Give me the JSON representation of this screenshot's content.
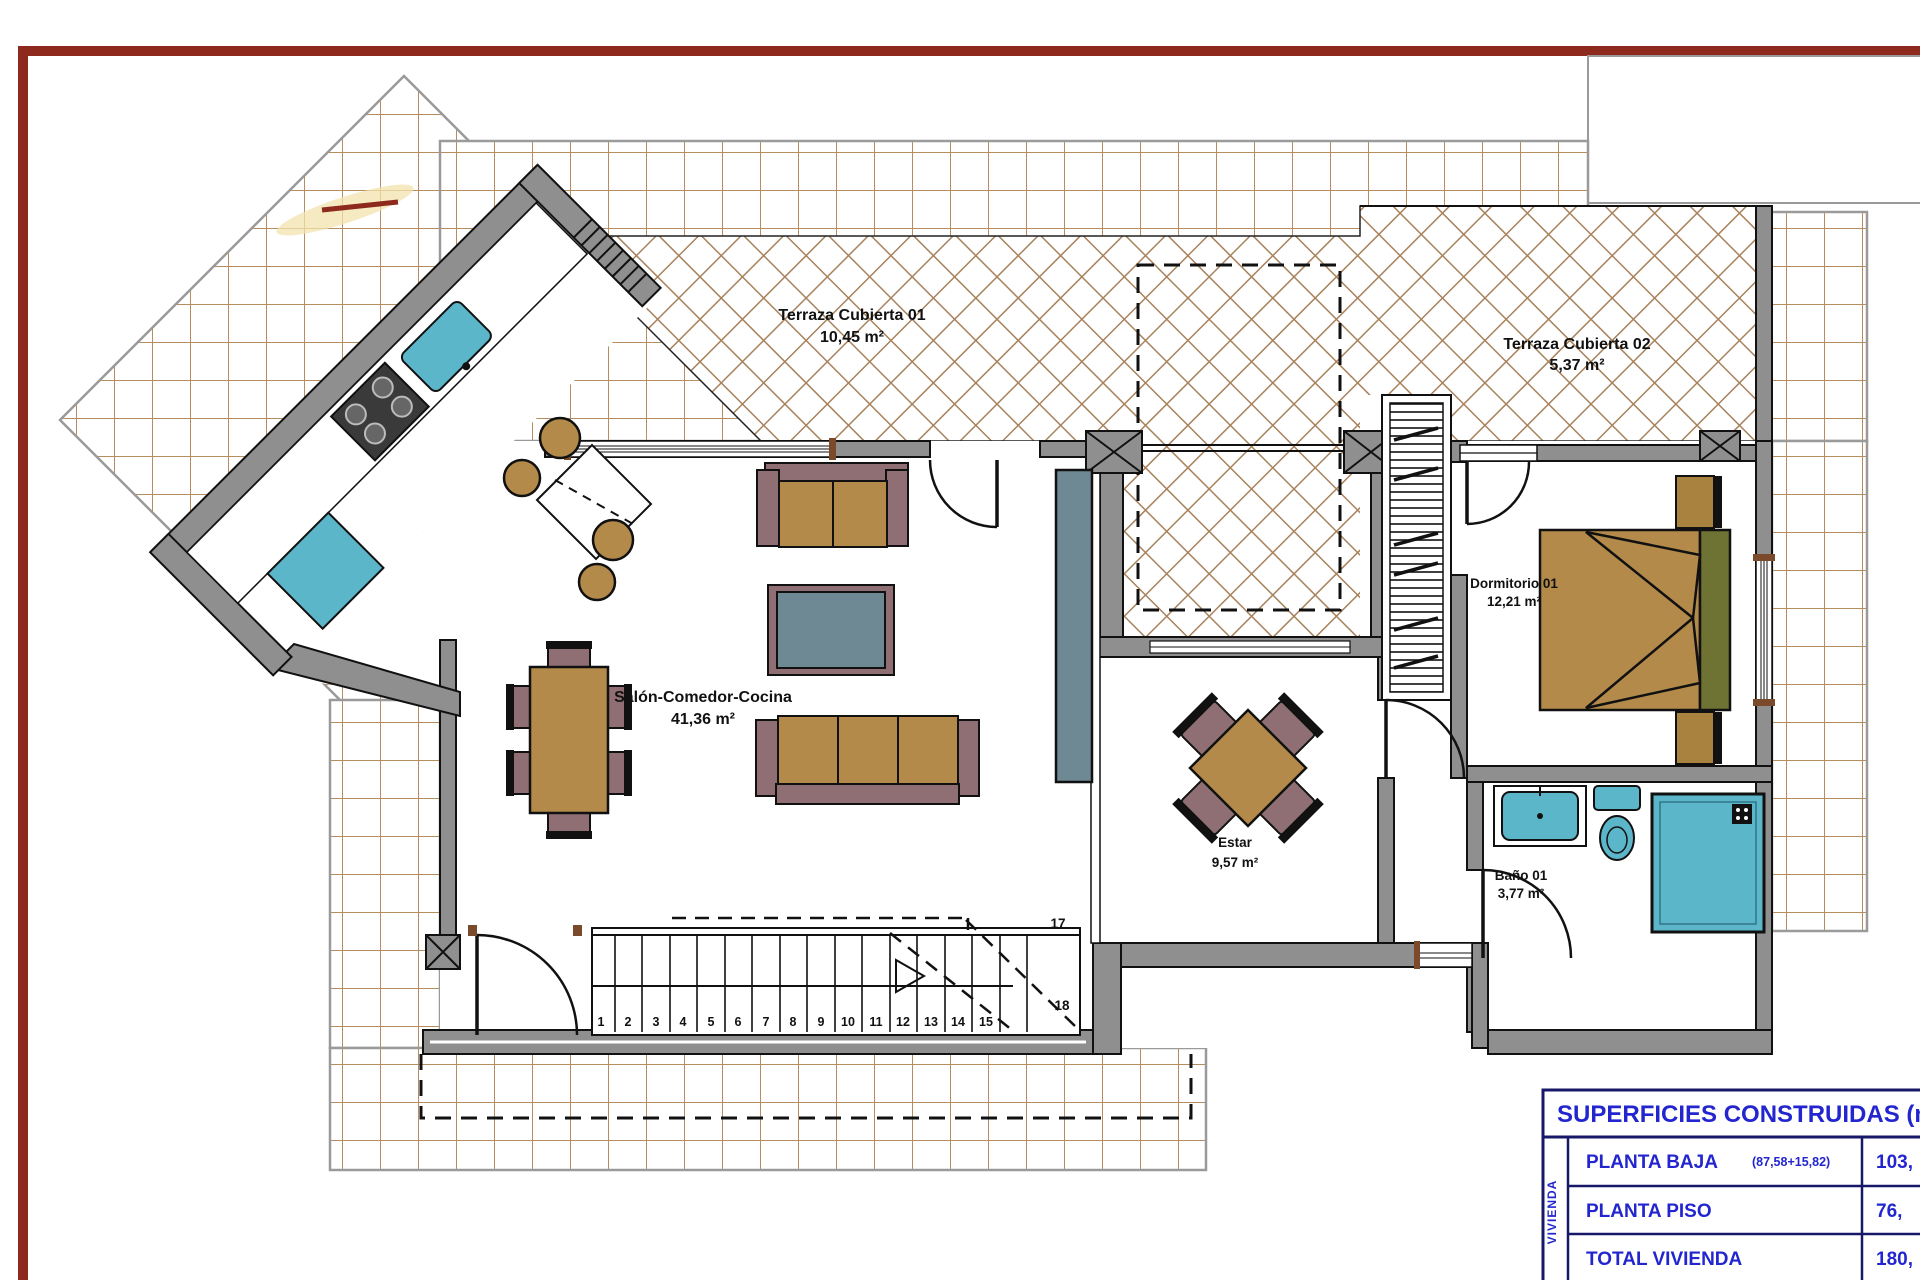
{
  "drawing": {
    "type": "floor-plan",
    "frame_color": "#8e2a1d"
  },
  "rooms": {
    "terraza01": {
      "name": "Terraza Cubierta 01",
      "area": "10,45 m²"
    },
    "terraza02": {
      "name": "Terraza Cubierta 02",
      "area": "5,37 m²"
    },
    "salon": {
      "name": "Salón-Comedor-Cocina",
      "area": "41,36 m²"
    },
    "dormitorio01": {
      "name": "Dormitorio 01",
      "area": "12,21 m²"
    },
    "estar": {
      "name": "Estar",
      "area": "9,57 m²"
    },
    "bano01": {
      "name": "Baño 01",
      "area": "3,77 m²"
    }
  },
  "stairs": {
    "steps": [
      "1",
      "2",
      "3",
      "4",
      "5",
      "6",
      "7",
      "8",
      "9",
      "10",
      "11",
      "12",
      "13",
      "14",
      "15"
    ],
    "mark_17": "17",
    "mark_18": "18"
  },
  "summary_table": {
    "title": "SUPERFICIES CONSTRUIDAS (m",
    "side_label": "VIVIENDA",
    "rows": [
      {
        "label": "PLANTA BAJA",
        "note": "(87,58+15,82)",
        "value": "103,"
      },
      {
        "label": "PLANTA PISO",
        "note": "",
        "value": "76,"
      },
      {
        "label": "TOTAL VIVIENDA",
        "note": "",
        "value": "180,"
      }
    ]
  },
  "colors": {
    "frame_maroon": "#8e2a1d",
    "table_blue": "#2326cf",
    "table_border": "#18186a",
    "tile_line": "#b68d5e",
    "hatch_line": "#a8825c",
    "wall_gray": "#8f8f8f",
    "furniture_tan": "#b38a4a",
    "furniture_mauve": "#8f6f74",
    "furniture_slate": "#6e8894",
    "fixture_teal": "#5cb6c9",
    "pillow_olive": "#6e7232"
  }
}
